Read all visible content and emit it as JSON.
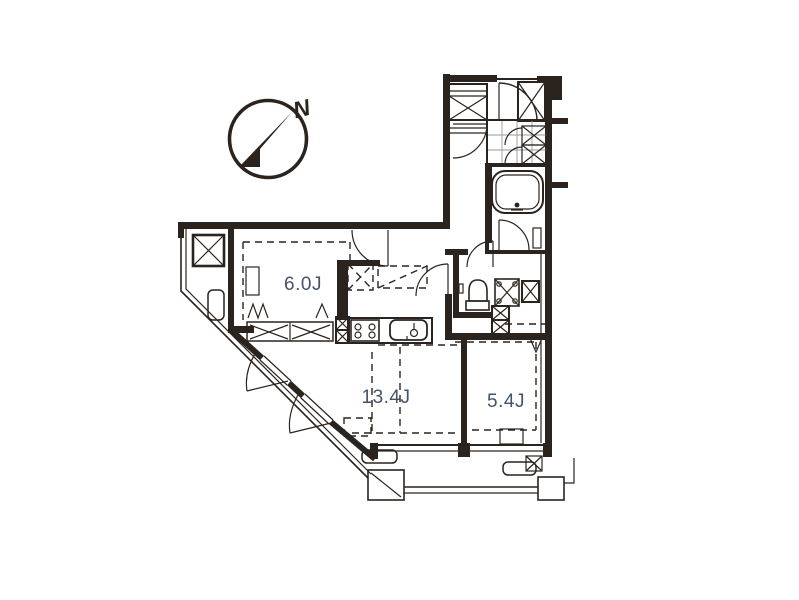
{
  "palette": {
    "background": "#ffffff",
    "line": "#2b241e",
    "room_label": "#44536a",
    "tile_grid": "#9a9a9a"
  },
  "compass": {
    "north_label": "N"
  },
  "rooms": [
    {
      "name": "bedroom-west",
      "label": "6.0J"
    },
    {
      "name": "living-dining-kitchen",
      "label": "13.4J"
    },
    {
      "name": "bedroom-east",
      "label": "5.4J"
    }
  ],
  "fixtures": [
    "compass-north-arrow-icon",
    "bathtub",
    "washroom-tile-floor",
    "toilet",
    "washing-machine-pan",
    "kitchen-sink",
    "gas-stove",
    "pipe-shaft-x-box",
    "meter-box",
    "shoe-cabinet",
    "closet-x-panels",
    "air-conditioner-outdoor-unit",
    "balcony-railing",
    "entrance-door-swing",
    "window-swing-flaps",
    "curtain-marks"
  ]
}
